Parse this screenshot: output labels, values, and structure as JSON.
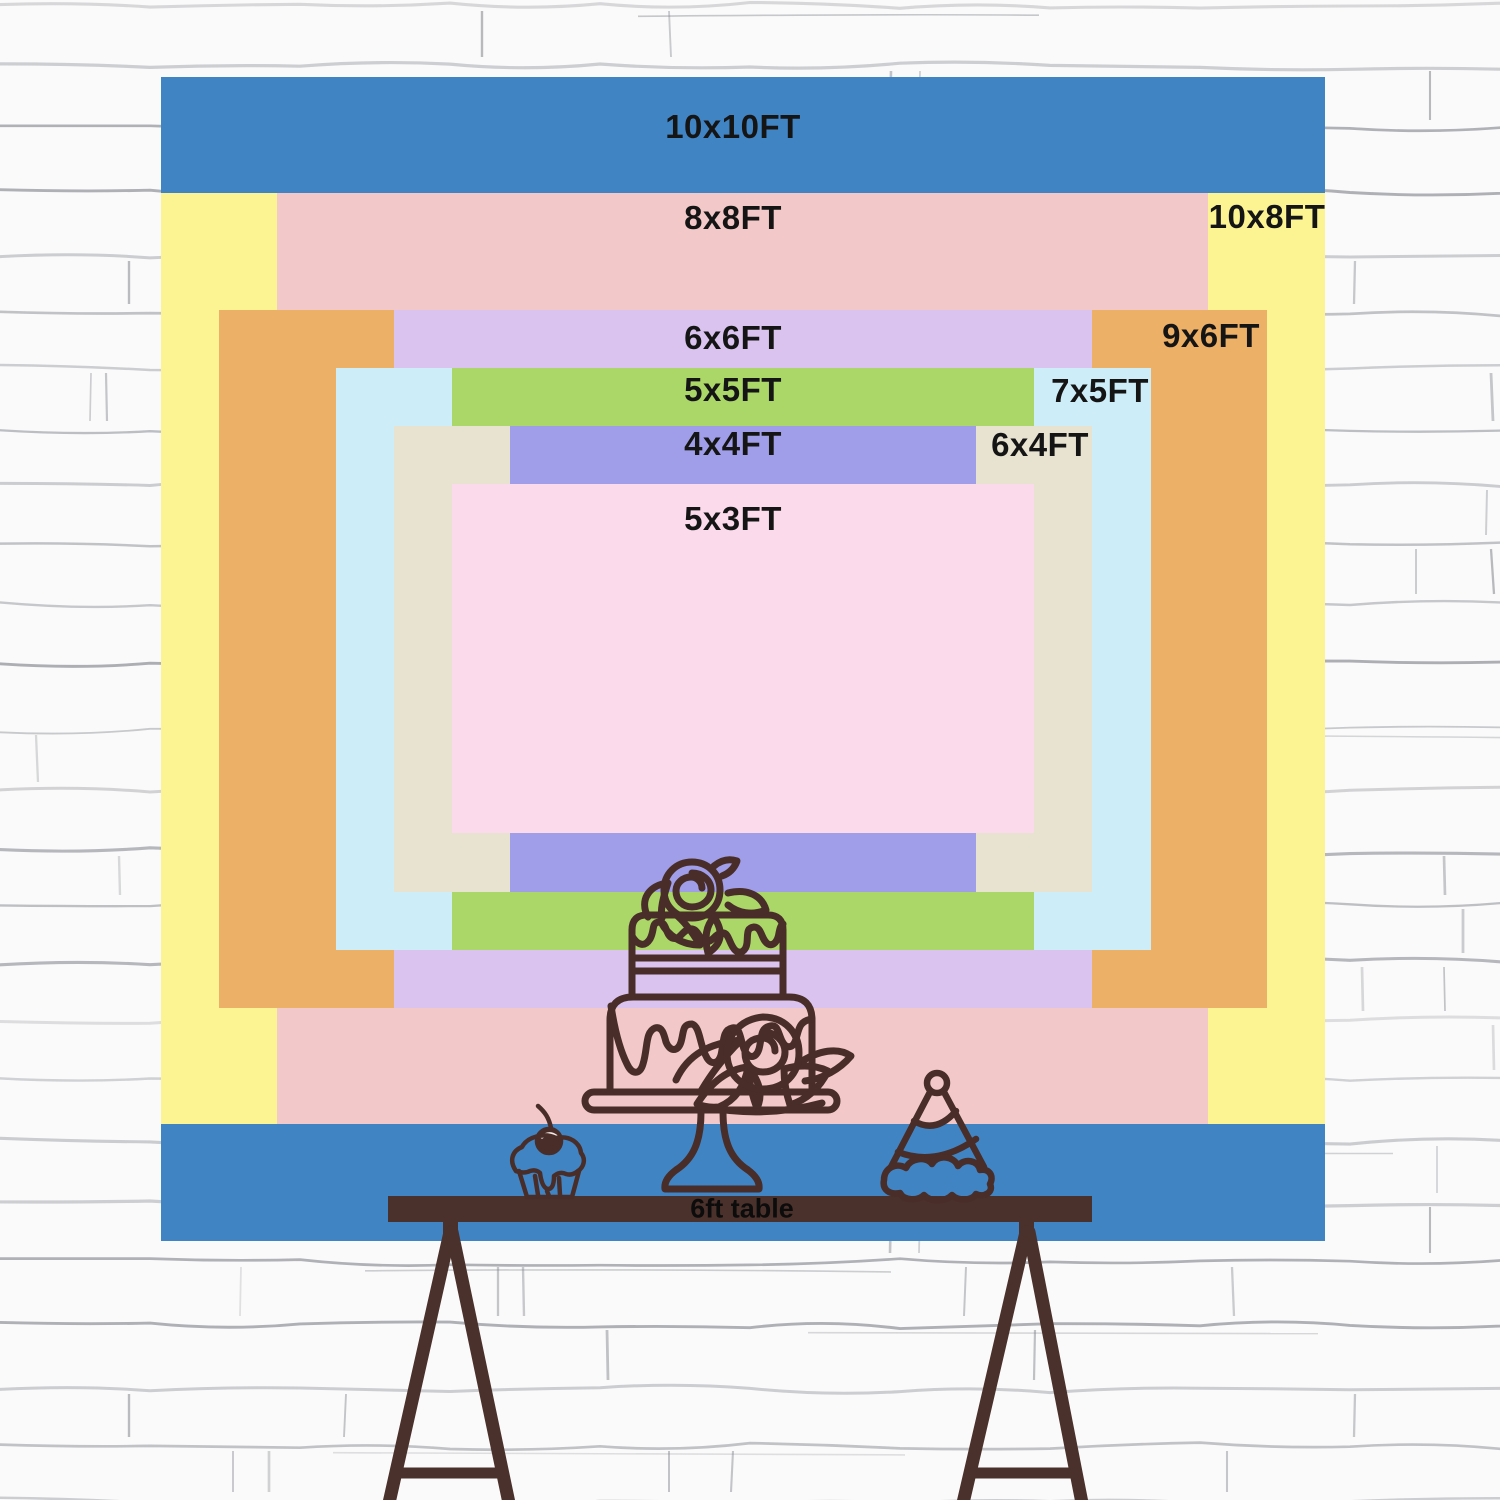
{
  "wall": {
    "color": "#fbfafa",
    "mortar_line_color": "#7e838b"
  },
  "backdrop_sizes": [
    {
      "id": "10x10ft",
      "label": "10x10FT",
      "width_ft": 10,
      "height_ft": 10,
      "color": "#4184c4"
    },
    {
      "id": "10x8ft",
      "label": "10x8FT",
      "width_ft": 10,
      "height_ft": 8,
      "color": "#fcf492"
    },
    {
      "id": "8x8ft",
      "label": "8x8FT",
      "width_ft": 8,
      "height_ft": 8,
      "color": "#f2c8c8"
    },
    {
      "id": "9x6ft",
      "label": "9x6FT",
      "width_ft": 9,
      "height_ft": 6,
      "color": "#ecb067"
    },
    {
      "id": "6x6ft",
      "label": "6x6FT",
      "width_ft": 6,
      "height_ft": 6,
      "color": "#dac3ee"
    },
    {
      "id": "7x5ft",
      "label": "7x5FT",
      "width_ft": 7,
      "height_ft": 5,
      "color": "#cdeef8"
    },
    {
      "id": "5x5ft",
      "label": "5x5FT",
      "width_ft": 5,
      "height_ft": 5,
      "color": "#abd668"
    },
    {
      "id": "6x4ft",
      "label": "6x4FT",
      "width_ft": 6,
      "height_ft": 4,
      "color": "#e8e3d1"
    },
    {
      "id": "4x4ft",
      "label": "4x4FT",
      "width_ft": 4,
      "height_ft": 4,
      "color": "#a09ee9"
    },
    {
      "id": "5x3ft",
      "label": "5x3FT",
      "width_ft": 5,
      "height_ft": 3,
      "color": "#fbdaec"
    }
  ],
  "label_text_color": "#151515",
  "table": {
    "label": "6ft table",
    "length_ft": 6,
    "color": "#4b312b"
  },
  "illustration": {
    "line_color": "#482d28",
    "items": [
      "cake-icon",
      "cupcake-icon",
      "party-hat-icon"
    ]
  }
}
